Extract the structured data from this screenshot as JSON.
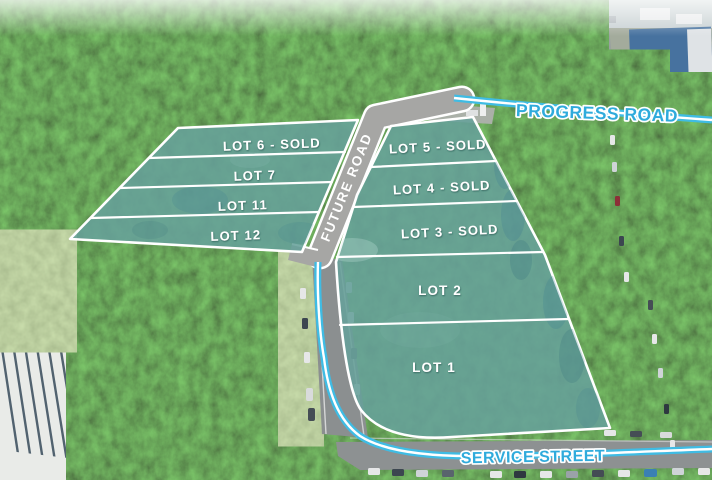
{
  "roads": {
    "progress": "PROGRESS ROAD",
    "future": "FUTURE ROAD",
    "service": "SERVICE STREET"
  },
  "lots": [
    {
      "id": "lot-6",
      "label": "LOT 6 - SOLD",
      "status": "sold"
    },
    {
      "id": "lot-7",
      "label": "LOT 7",
      "status": "available"
    },
    {
      "id": "lot-11",
      "label": "LOT 11",
      "status": "available"
    },
    {
      "id": "lot-12",
      "label": "LOT 12",
      "status": "available"
    },
    {
      "id": "lot-5",
      "label": "LOT 5 - SOLD",
      "status": "sold"
    },
    {
      "id": "lot-4",
      "label": "LOT 4 - SOLD",
      "status": "sold"
    },
    {
      "id": "lot-3",
      "label": "LOT 3 - SOLD",
      "status": "sold"
    },
    {
      "id": "lot-2",
      "label": "LOT 2",
      "status": "available"
    },
    {
      "id": "lot-1",
      "label": "LOT 1",
      "status": "available"
    }
  ],
  "colors": {
    "lot_fill": "#66A09A",
    "road_label_text": "#2FABDC",
    "route_line": "#3FBCE4",
    "future_road_fill": "#A6A6A4",
    "lot_label_text": "#FFFFFF"
  }
}
